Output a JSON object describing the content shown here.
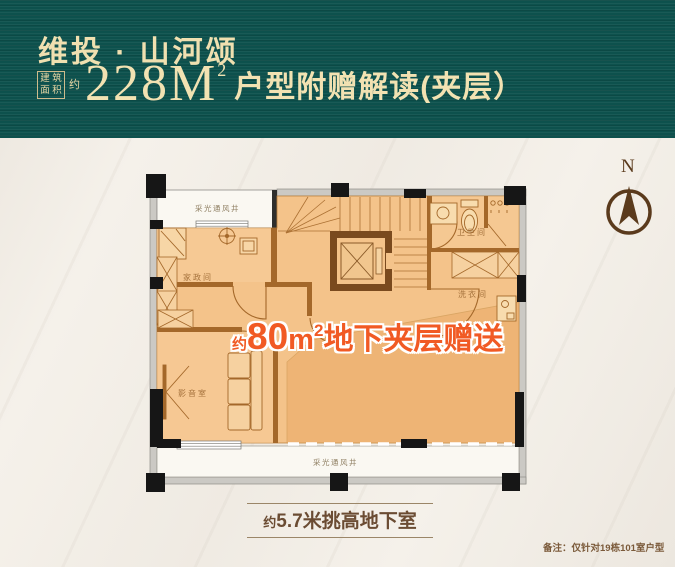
{
  "header": {
    "brand": "维投 · 山河颂",
    "area": {
      "box_chars": [
        "建",
        "筑",
        "面",
        "积"
      ],
      "approx": "约",
      "number": "228",
      "unit": "M",
      "sup": "2"
    },
    "subtitle": "户型附赠解读(夹层）"
  },
  "compass": {
    "label": "N"
  },
  "floorplan": {
    "light_well_top": "采光通风井",
    "light_well_bottom": "采光通风井",
    "rooms": [
      {
        "id": "housekeeping",
        "label": "家政间"
      },
      {
        "id": "bathroom",
        "label": "卫生间"
      },
      {
        "id": "laundry",
        "label": "洗衣间"
      },
      {
        "id": "av-room",
        "label": "影音室"
      }
    ],
    "promo": {
      "approx": "约",
      "number": "80",
      "unit": "m",
      "sup": "2",
      "suffix": "地下夹层赠送"
    }
  },
  "footer": {
    "height_label": {
      "approx": "约",
      "text": "5.7米挑高地下室"
    },
    "note": "备注：仅针对19栋101室户型"
  },
  "colors": {
    "header_bg": "#0d514d",
    "header_text": "#f2e2b2",
    "floor_fill": "#f4c38a",
    "floor_fill_dark": "#edaf6e",
    "inner_wall": "#a4682a",
    "elevator_wall": "#7a4a1e",
    "promo_orange": "#f15a24",
    "label_brown": "#a5723c",
    "footer_brown": "#6b4c33",
    "background": "#f5f1ea"
  }
}
